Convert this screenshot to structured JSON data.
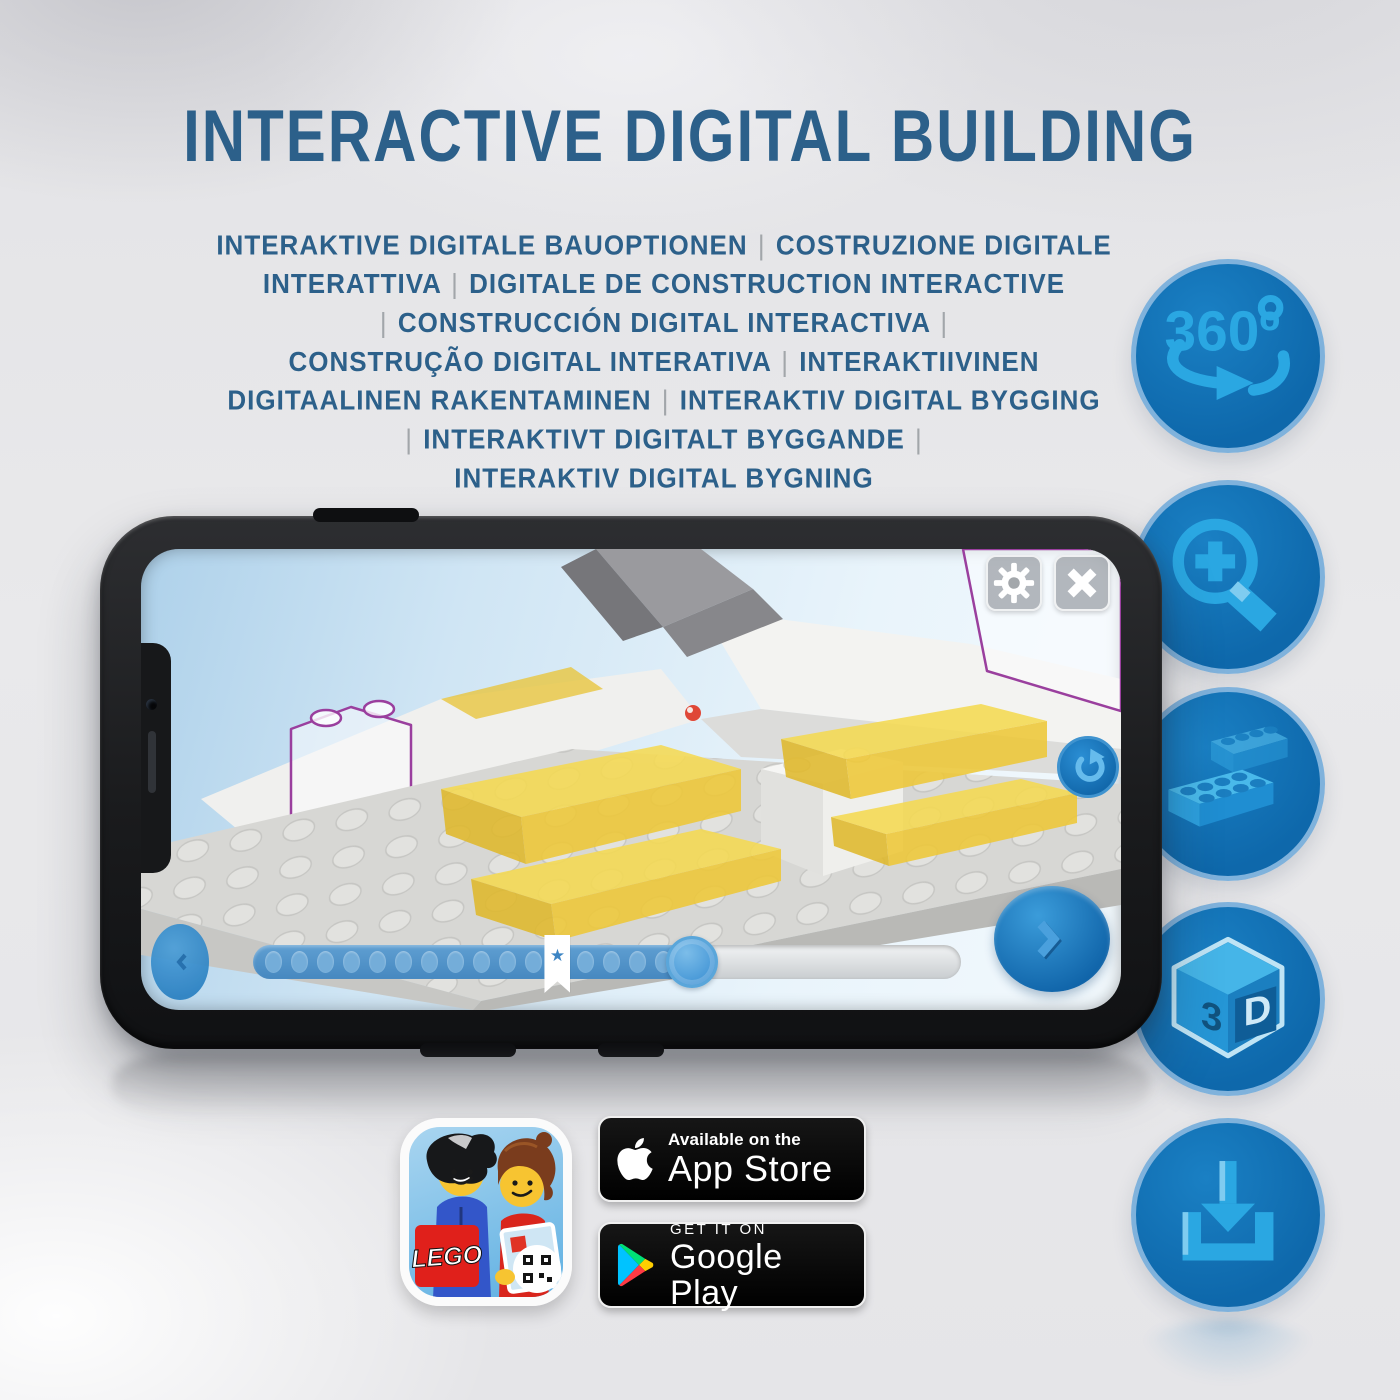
{
  "header": {
    "title": "INTERACTIVE DIGITAL BUILDING",
    "subtitle_lines": [
      "INTERAKTIVE DIGITALE BAUOPTIONEN | COSTRUZIONE DIGITALE",
      "INTERATTIVA | DIGITALE DE CONSTRUCTION INTERACTIVE",
      "| CONSTRUCCIÓN DIGITAL INTERACTIVA |",
      "CONSTRUÇÃO DIGITAL INTERATIVA | INTERAKTIIVINEN",
      "DIGITAALINEN RAKENTAMINEN | INTERAKTIV DIGITAL BYGGING",
      "| INTERAKTIVT DIGITALT BYGGANDE |",
      "INTERAKTIV DIGITAL BYGNING"
    ]
  },
  "features": [
    {
      "icon": "360-rotation-icon",
      "label": "360",
      "degree": "º"
    },
    {
      "icon": "zoom-in-icon"
    },
    {
      "icon": "stacked-bricks-icon"
    },
    {
      "icon": "3d-cube-icon",
      "label_left": "3",
      "label_right": "D"
    },
    {
      "icon": "download-icon"
    }
  ],
  "phone_app": {
    "slider": {
      "dot_count": 16,
      "progress_percent": 62,
      "bookmark_percent": 43,
      "bookmark_glyph": "★"
    }
  },
  "store_badges": {
    "app_store": {
      "top_line": "Available on the",
      "bottom_line": "App Store"
    },
    "google_play": {
      "top_line": "GET IT ON",
      "bottom_line": "Google Play"
    },
    "lego_app": {
      "logo_text": "LEGO"
    }
  },
  "colors": {
    "title_blue": "#2c608a",
    "circle_fill_blue": "#1273b8",
    "circle_icon_blue": "#2aa7e2",
    "highlight_yellow": "#f3d74d",
    "ghost_outline_purple": "#9a3f9e",
    "screen_sky_blue": "#cfe5f4"
  }
}
